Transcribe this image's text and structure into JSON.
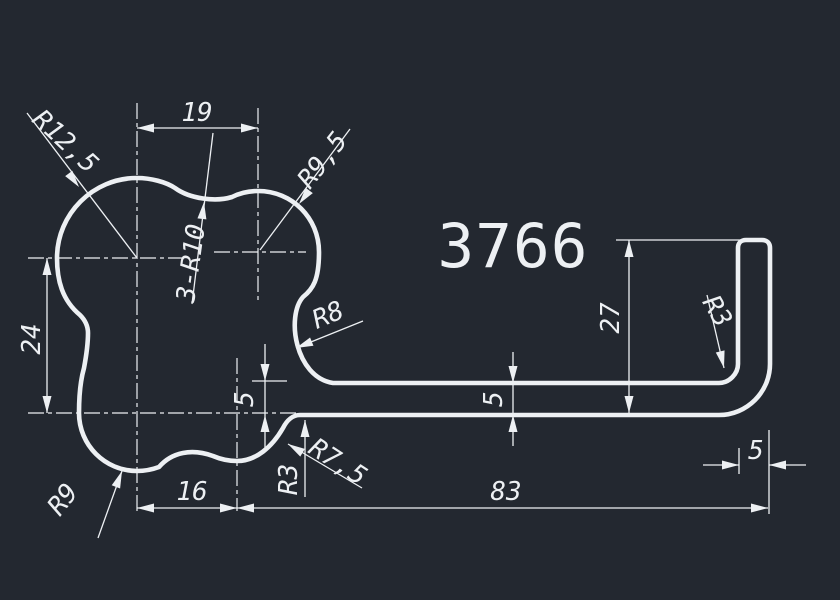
{
  "canvas": {
    "background": "#232830",
    "line_color": "#edf0f3"
  },
  "part_number": "3766",
  "dimensions": {
    "top_lobe_spacing": "19",
    "lobe_vertical_spacing": "24",
    "bottom_left_spacing": "16",
    "strip_length": "83",
    "hook_height": "27",
    "strip_thickness_left": "5",
    "strip_thickness_mid": "5",
    "hook_width": "5"
  },
  "radius_labels": {
    "top_left_lobe": "R12,5",
    "top_right_lobe": "R9,5",
    "concave_waists": "3-R10",
    "strip_top_fillet": "R8",
    "bottom_left_lobe": "R9",
    "bottom_right_lobe": "R7,5",
    "strip_bottom_fillet": "R3",
    "hook_inner_fillet": "R3"
  }
}
